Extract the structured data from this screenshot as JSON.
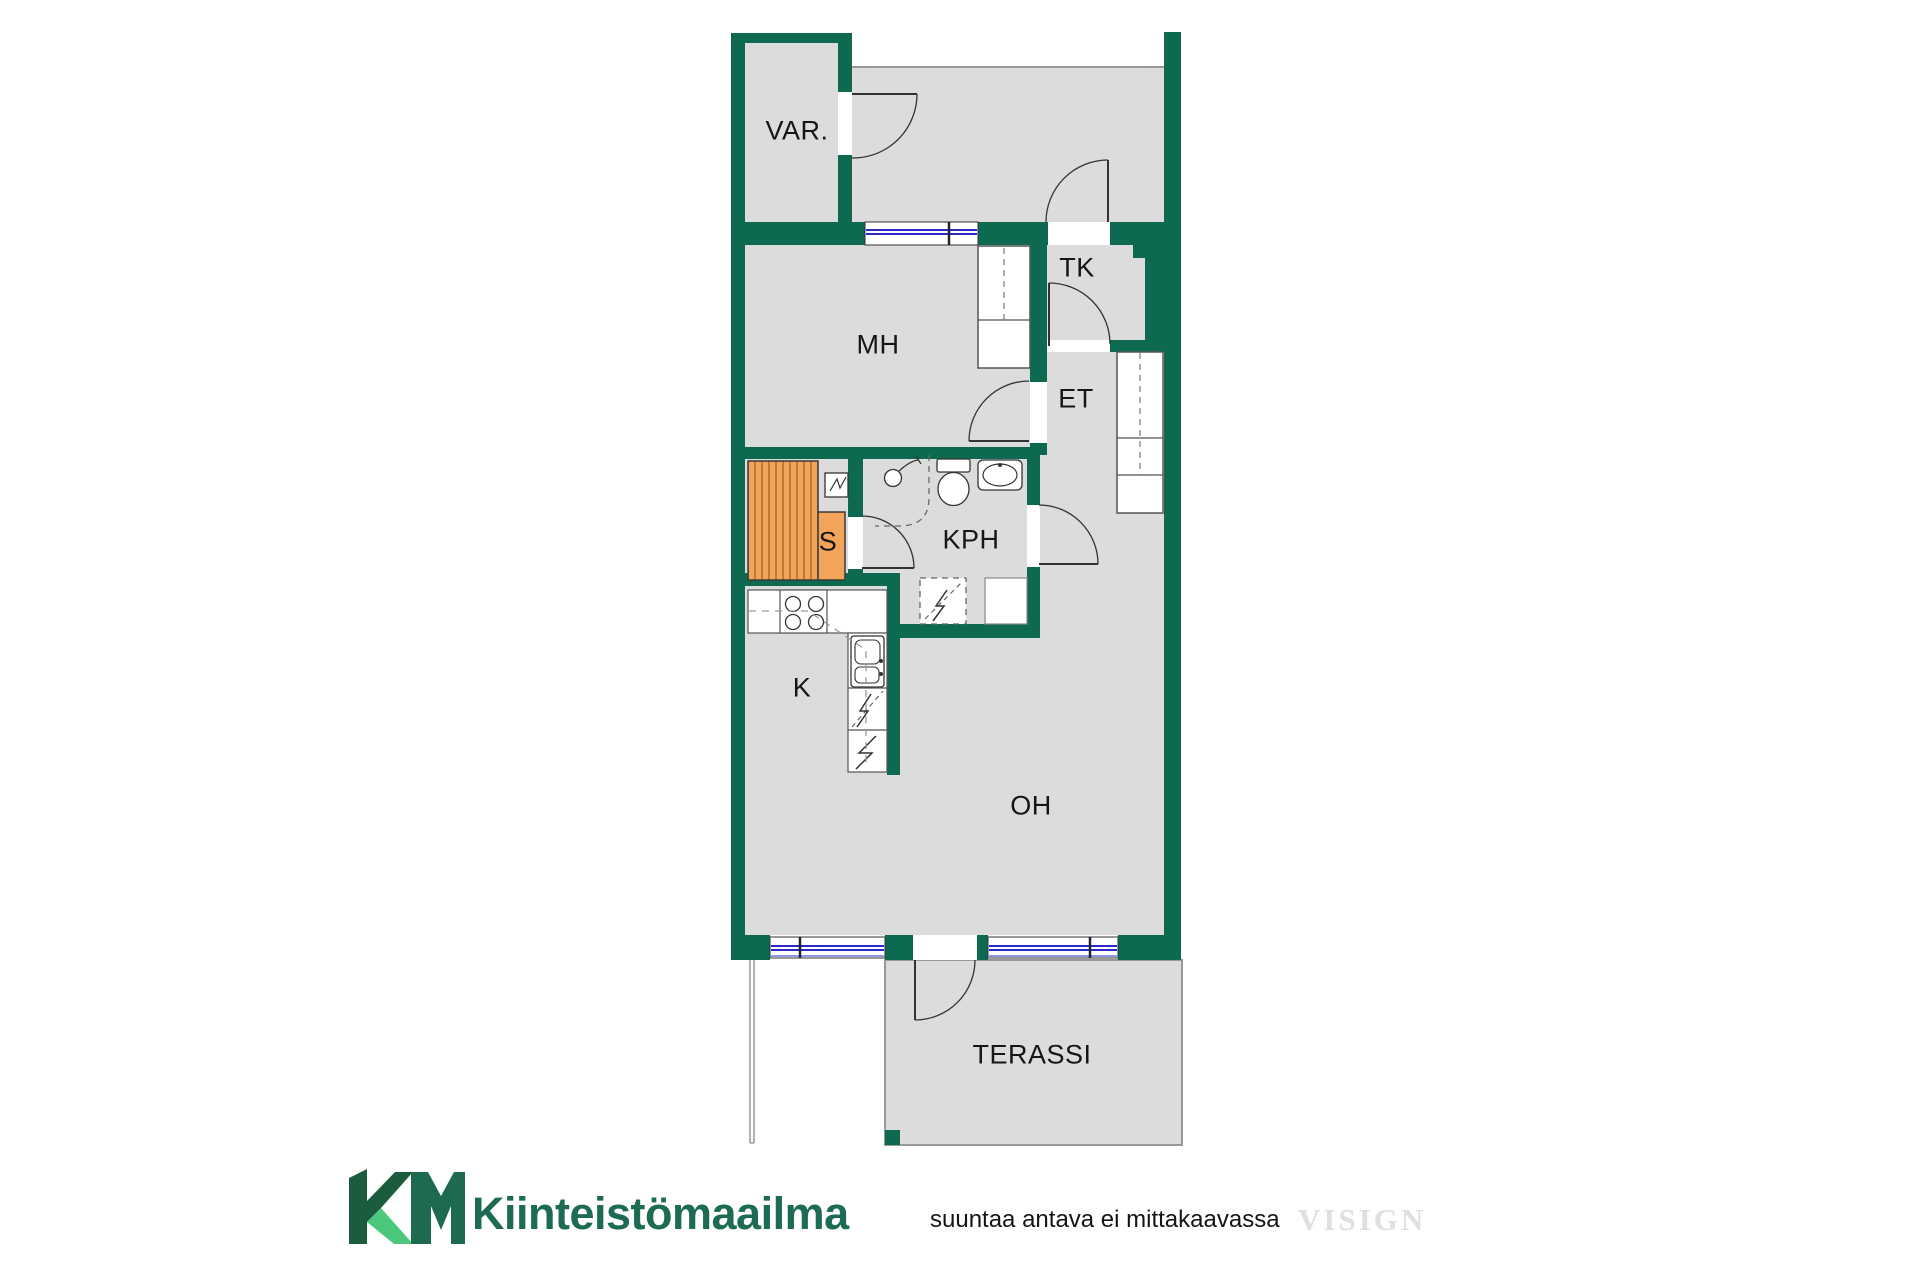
{
  "title": "floor-plan",
  "colors": {
    "wall": "#0d6a50",
    "floor": "#dcdcdc",
    "sauna-orange": "#f2a45a",
    "sauna-stripe": "#bc7c33",
    "window-blue": "#2a2ac8",
    "line": "#333333",
    "thin": "#999999",
    "logo-dark": "#1b5c3e",
    "logo-mid": "#1d6a50",
    "logo-light": "#4cc87d",
    "brand-text": "#1e6b55",
    "watermark": "#e2dfdf"
  },
  "rooms": {
    "var": "VAR.",
    "tk": "TK",
    "mh": "MH",
    "et": "ET",
    "sauna": "S",
    "kph": "KPH",
    "kitchen": "K",
    "oh": "OH",
    "terrace": "TERASSI"
  },
  "fixtures": [
    "sauna-bench",
    "sauna-heater",
    "shower",
    "toilet",
    "washbasin",
    "washing-machine-reservation",
    "wardrobe",
    "hallway-closet",
    "stove",
    "kitchen-sink",
    "dishwasher-reservation",
    "kitchen-appliance"
  ],
  "footer": {
    "logo_monogram": "KM",
    "brand": "Kiinteistömaailma",
    "disclaimer": "suuntaa antava ei mittakaavassa",
    "watermark": "VISIGN"
  }
}
